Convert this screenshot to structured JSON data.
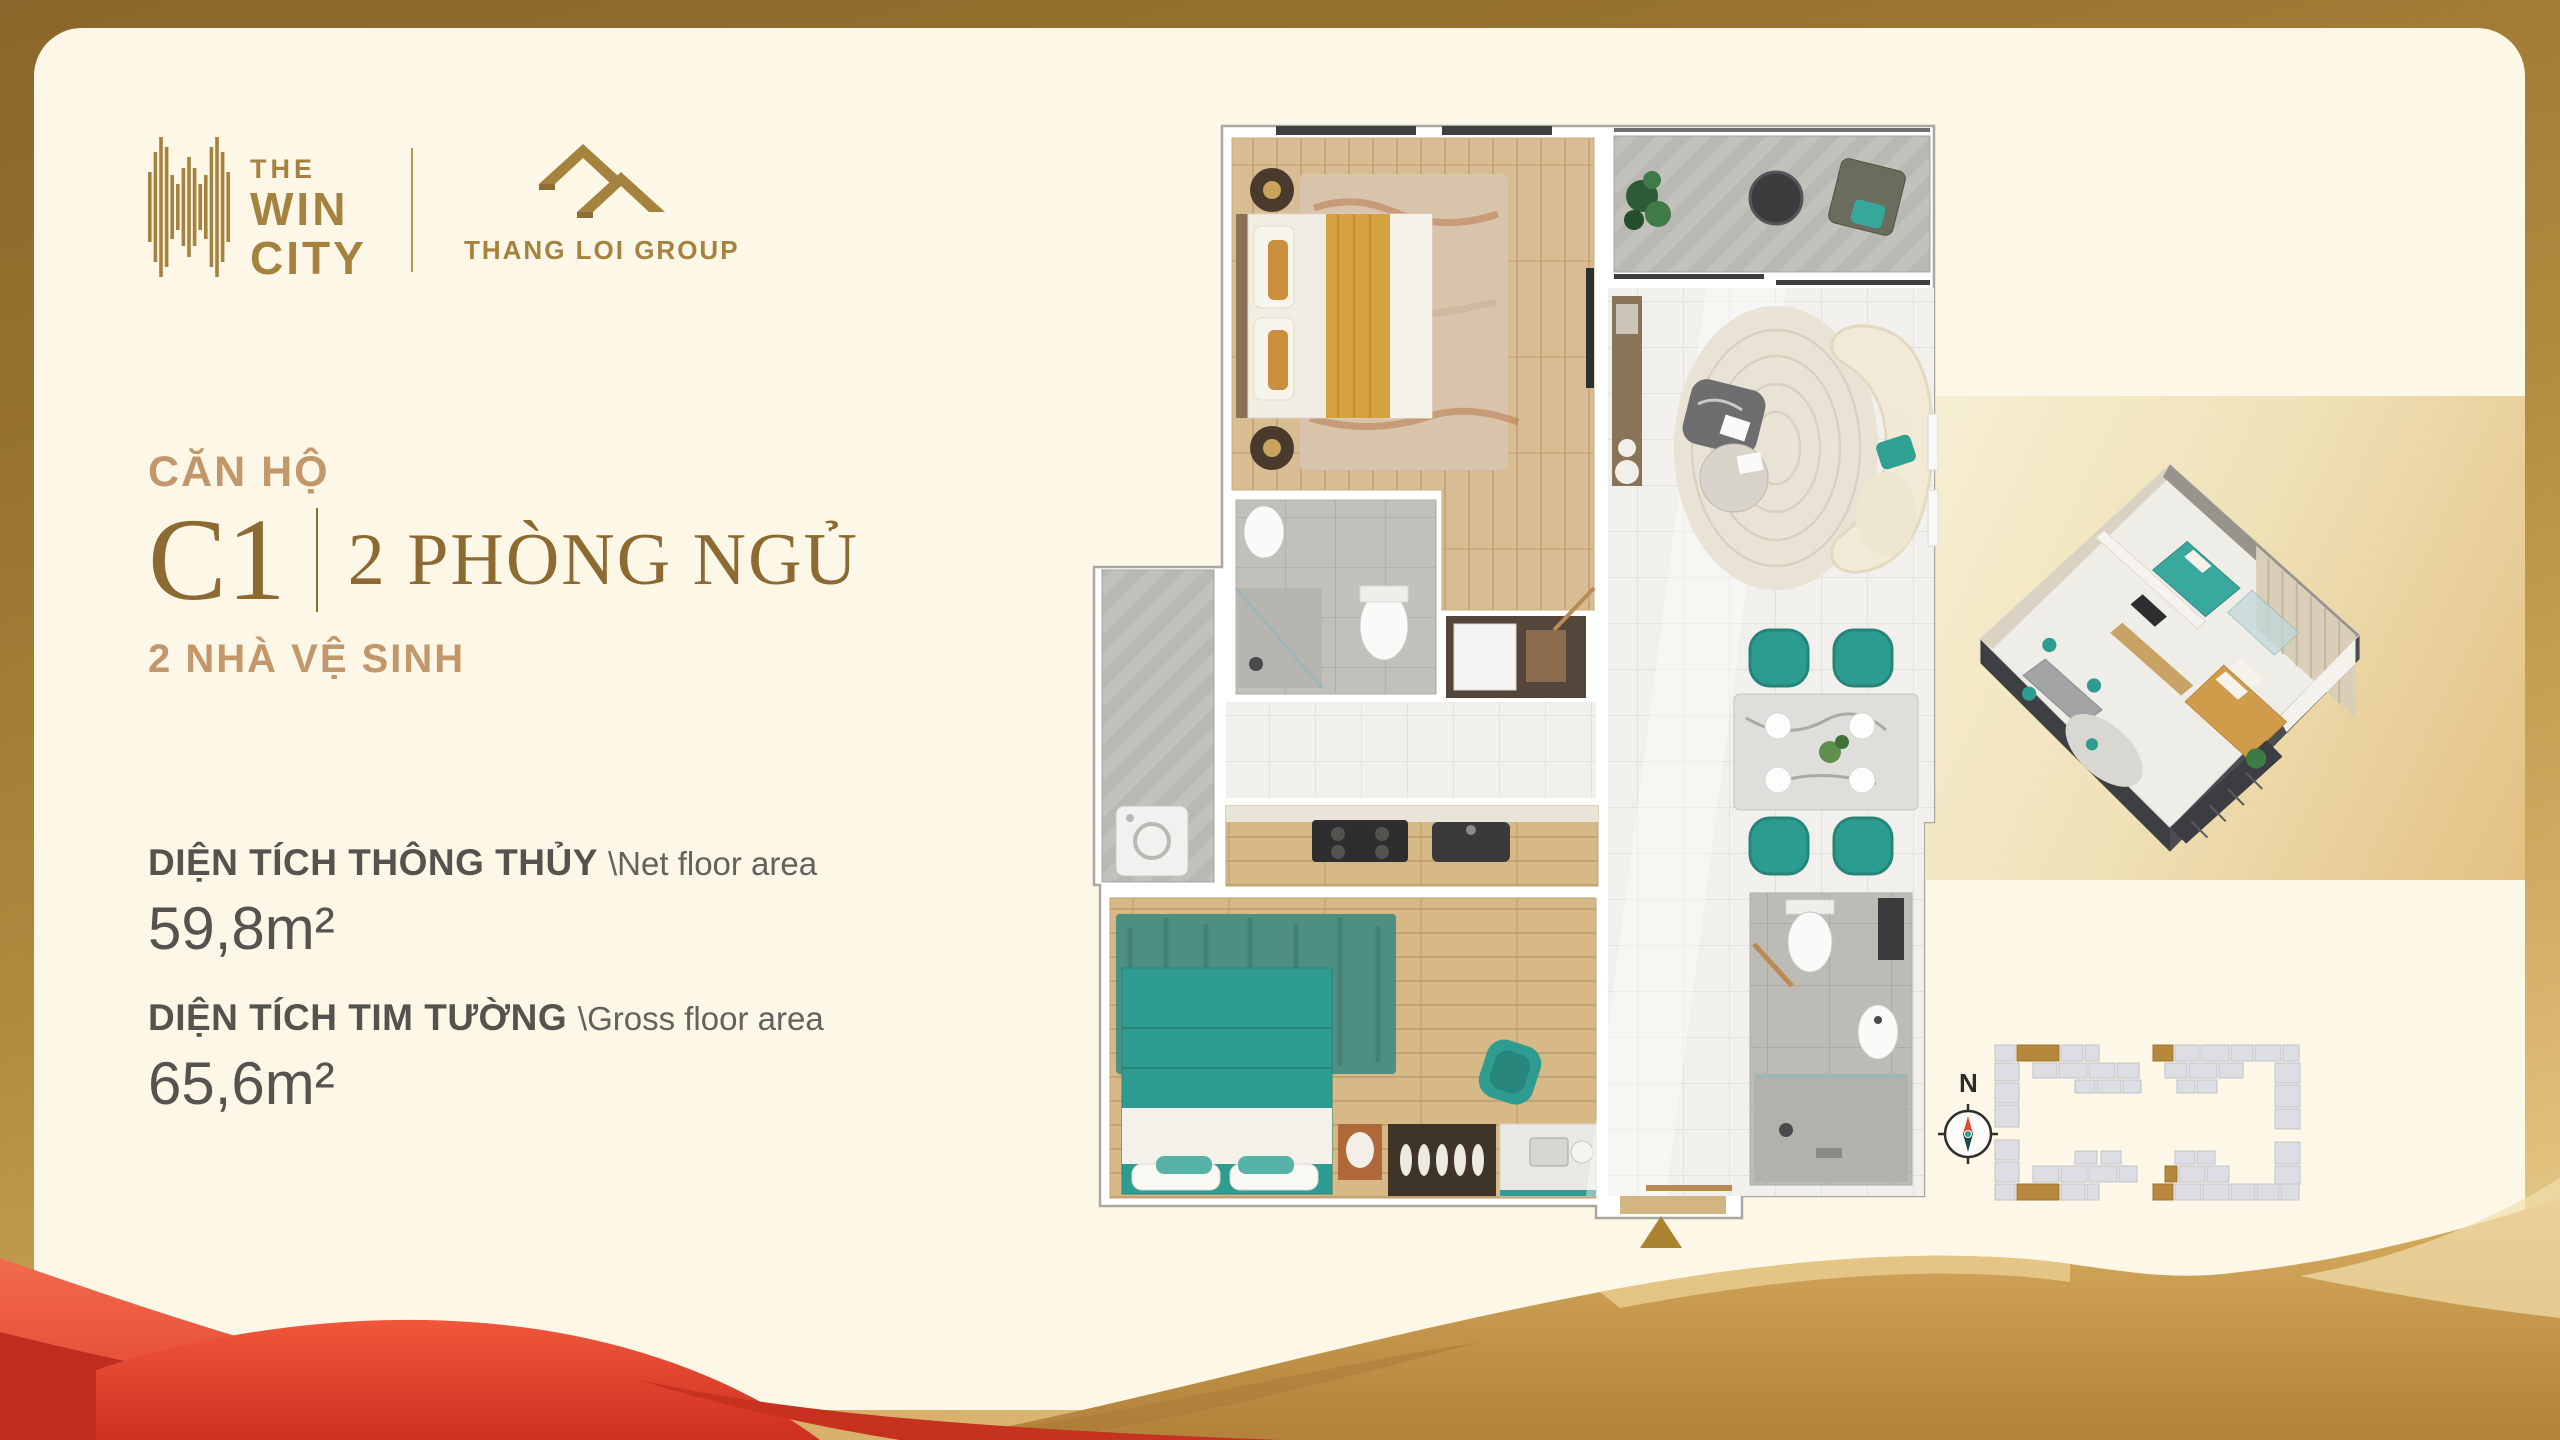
{
  "brand": {
    "line1": "THE",
    "line2": "WIN",
    "line3": "CITY",
    "developer": "THANG LOI GROUP"
  },
  "unit": {
    "category_label": "CĂN HỘ",
    "code": "C1",
    "bedrooms_label": "2 PHÒNG NGỦ",
    "bathrooms_label": "2 NHÀ VỆ SINH"
  },
  "areas": {
    "net": {
      "label_vi": "DIỆN TÍCH THÔNG THỦY",
      "label_en": "\\Net floor area",
      "value": "59,8m²"
    },
    "gross": {
      "label_vi": "DIỆN TÍCH TIM TƯỜNG",
      "label_en": "\\Gross floor area",
      "value": "65,6m²"
    }
  },
  "site_plan": {
    "compass_label": "N"
  },
  "palette": {
    "logo_gold": "#A6823F",
    "tan_heading": "#C2976B",
    "serif_brown": "#8C6A32",
    "dark_text": "#55534E",
    "cream_bg": "#FCF7E6",
    "frame_gold_dark": "#8A672A",
    "frame_gold_light": "#F0D79C",
    "teal_accent": "#2F9C91",
    "red_wave": "#DC3425",
    "gold_wave": "#C79B55",
    "entry_marker": "#A9832F"
  }
}
